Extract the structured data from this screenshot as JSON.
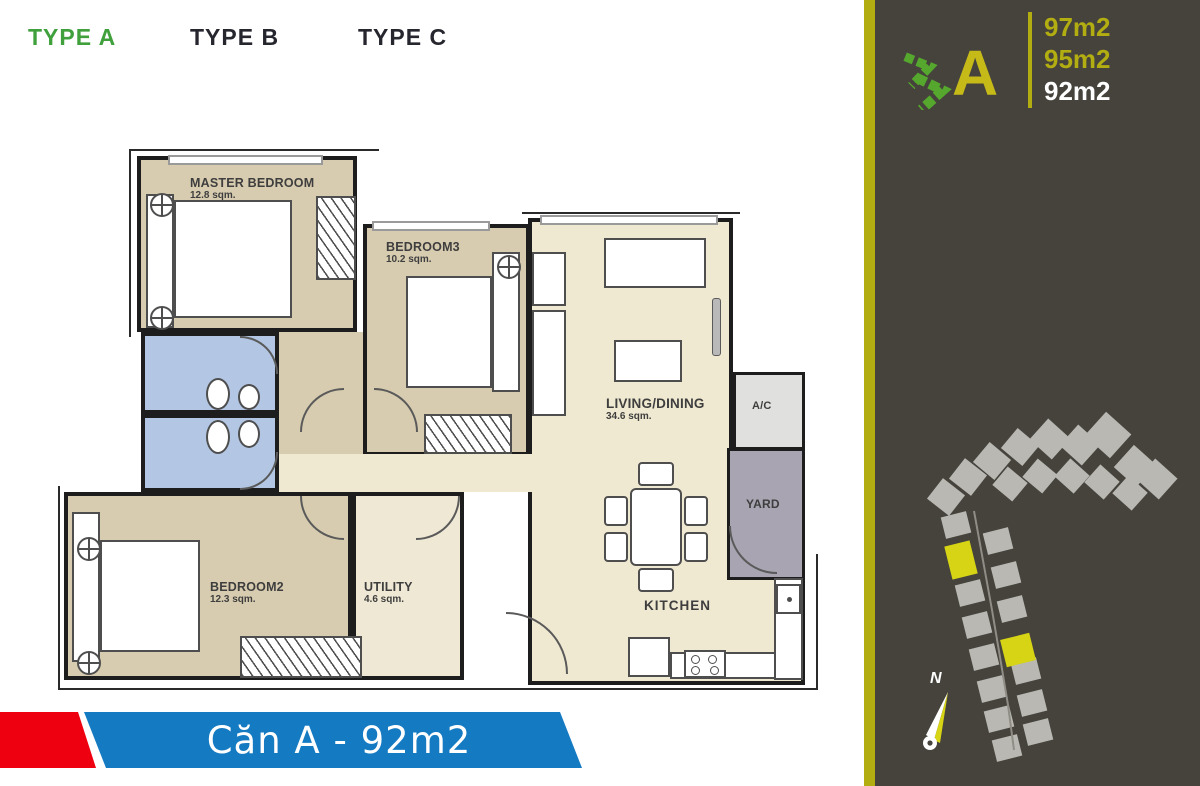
{
  "tabs": [
    {
      "label": "TYPE A",
      "active": true
    },
    {
      "label": "TYPE B",
      "active": false
    },
    {
      "label": "TYPE C",
      "active": false
    }
  ],
  "banner": {
    "title": "Căn A - 92m2"
  },
  "panel": {
    "type_letter": "A",
    "areas": [
      {
        "label": "97m2",
        "highlight": false
      },
      {
        "label": "95m2",
        "highlight": false
      },
      {
        "label": "92m2",
        "highlight": true
      }
    ],
    "compass_label": "N"
  },
  "floorplan": {
    "rooms": [
      {
        "id": "master",
        "name": "MASTER BEDROOM",
        "area": "12.8 sqm."
      },
      {
        "id": "bedroom3",
        "name": "BEDROOM3",
        "area": "10.2 sqm."
      },
      {
        "id": "bedroom2",
        "name": "BEDROOM2",
        "area": "12.3 sqm."
      },
      {
        "id": "utility",
        "name": "UTILITY",
        "area": "4.6 sqm."
      },
      {
        "id": "living",
        "name": "LIVING/DINING",
        "area": "34.6 sqm."
      },
      {
        "id": "kitchen",
        "name": "KITCHEN",
        "area": ""
      },
      {
        "id": "ac",
        "name": "A/C",
        "area": ""
      },
      {
        "id": "yard",
        "name": "YARD",
        "area": ""
      }
    ]
  },
  "colors": {
    "tab_active": "#3fa03c",
    "panel_bg": "#45433c",
    "accent_olive": "#b2ad11",
    "letter_yellow": "#c6ba18",
    "chevron_green": "#55a82d",
    "banner_red": "#ee0011",
    "banner_blue": "#147ac2",
    "room_beige": "#d8ccb0",
    "hall_cream": "#f0e9d1",
    "bath_blue": "#b3c7e5",
    "yard_gray": "#a8a4b2",
    "site_block_gray": "#b9b8b2",
    "site_block_yellow": "#d6d414"
  }
}
